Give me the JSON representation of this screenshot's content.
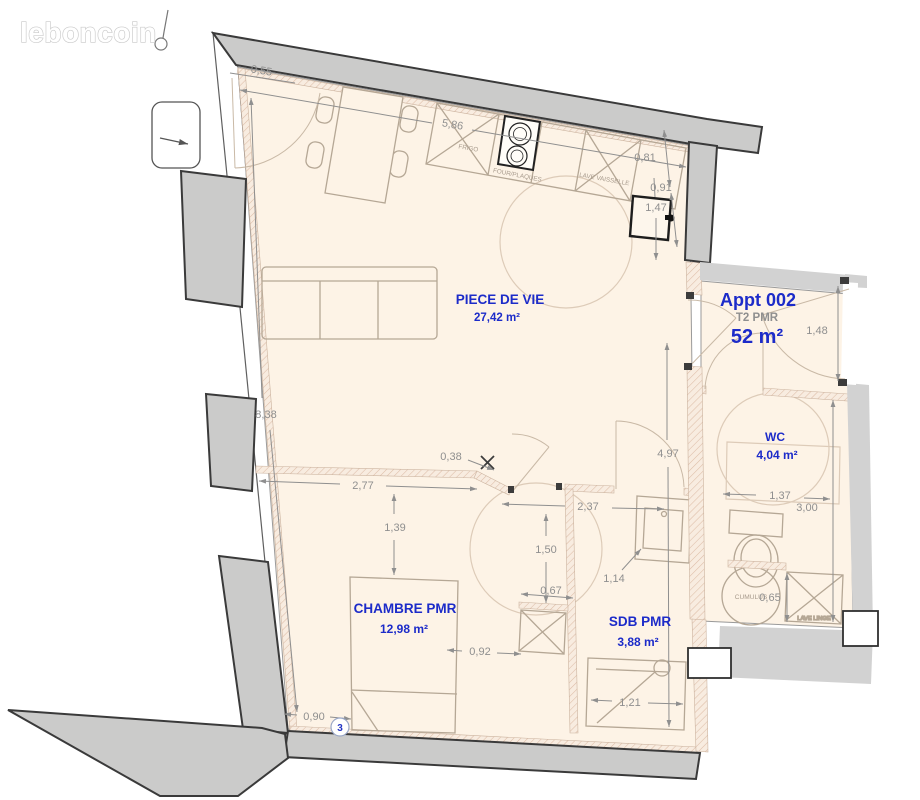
{
  "logo": {
    "text": "leboncoin"
  },
  "apartment": {
    "name": "Appt 002",
    "type": "T2 PMR",
    "area": "52 m²"
  },
  "rooms": {
    "living": {
      "name": "PIECE DE VIE",
      "area": "27,42 m²"
    },
    "bedroom": {
      "name": "CHAMBRE PMR",
      "area": "12,98 m²"
    },
    "bathroom": {
      "name": "SDB PMR",
      "area": "3,88 m²"
    },
    "wc": {
      "name": "WC",
      "area": "4,04 m²"
    }
  },
  "appliances": {
    "fridge": "FRIGO",
    "oven": "FOUR/PLAQUES",
    "dishwasher": "LAVE VAISSELLE",
    "washer": "LAVE LINGE",
    "water_heater": "CUMULUS"
  },
  "dimensions": {
    "entry_wall": "0,55",
    "living_width": "5,86",
    "kitchen_return": "0,81",
    "corner_offset": "0,91",
    "shaft": "1,47",
    "entry_door": "1,48",
    "left_wall": "8,38",
    "partition_stub": "0,38",
    "bedroom_wall": "2,77",
    "bedroom_clear": "1,39",
    "hall_length": "4,97",
    "hall_width": "2,37",
    "turning_radius": "1,50",
    "wc_width": "1,37",
    "wc_length": "3,00",
    "vanity": "1,14",
    "closet_offset": "0,67",
    "closet_width": "0,92",
    "bed_offset": "0,90",
    "shower": "1,21",
    "washer_width": "0,65"
  },
  "marker": {
    "label": "3"
  },
  "colors": {
    "accent_blue": "#1c2bc9",
    "label_gray": "#8f8f8f",
    "wall_fill": "#cbcbca",
    "wall_stroke": "#3a3a3a",
    "common_fill": "#d2d2d2",
    "floor_fill": "#fdf3e6",
    "furniture_stroke": "#b5a795"
  }
}
